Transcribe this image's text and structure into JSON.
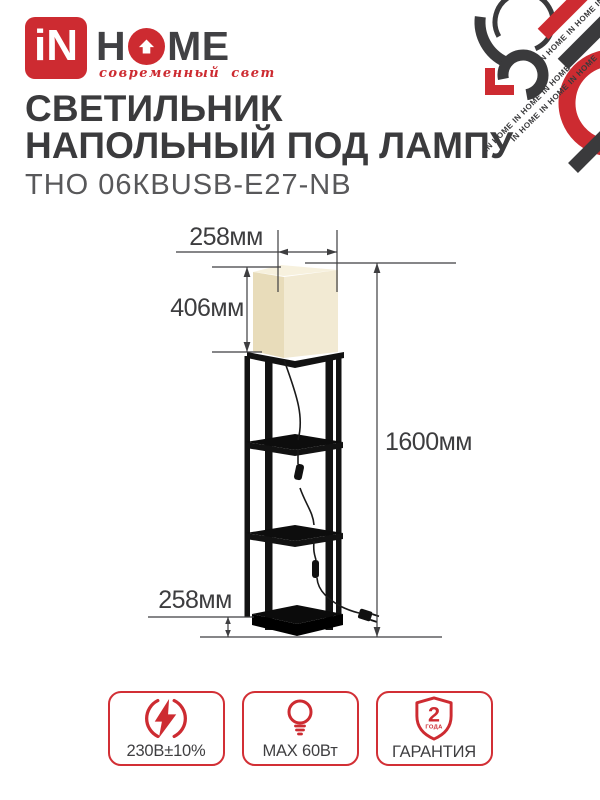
{
  "brand": {
    "mark": "iN",
    "name_left": "H",
    "name_right": "ME",
    "tagline": "современный свет",
    "pattern_text": "IN HOME  IN HOME  IN HOME"
  },
  "header": {
    "title_line1": "СВЕТИЛЬНИК",
    "title_line2": "НАПОЛЬНЫЙ ПОД ЛАМПУ",
    "model": "ТНО 06КBUSB-E27-NB"
  },
  "diagram": {
    "shade_width": "258мм",
    "shade_height": "406мм",
    "total_height": "1600мм",
    "base_depth": "258мм"
  },
  "badges": [
    {
      "icon": "voltage-icon",
      "label": "230В±10%"
    },
    {
      "icon": "bulb-icon",
      "label": "MAX 60Вт"
    },
    {
      "icon": "warranty-shield-icon",
      "label": "ГАРАНТИЯ",
      "shield_number": "2",
      "shield_unit": "ГОДА"
    }
  ],
  "colors": {
    "brand_red": "#cd2b31",
    "text_dark": "#3b3b3d",
    "shade_front": "#f2ead3",
    "shade_side": "#e8dcba",
    "frame_black": "#121212"
  }
}
